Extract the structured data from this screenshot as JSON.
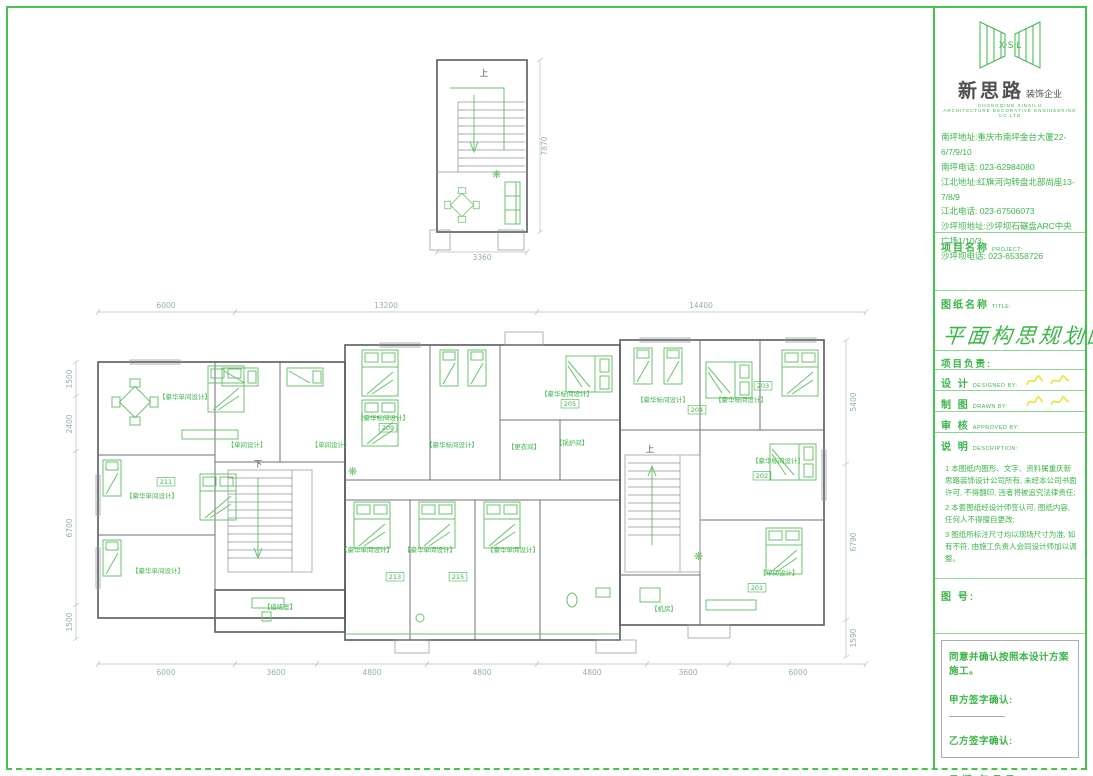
{
  "brand": {
    "logo_initials": "X·S·L",
    "name": "新思路",
    "suffix": "装饰企业",
    "subtitle_cn": "CHONGQING XINSILU",
    "subtitle_en": "ARCHITECTURE DECORATIVE ENGINEERING CO.LTD"
  },
  "addresses": [
    "南坪地址:重庆市南坪金台大厦22-6/7/9/10",
    "南坪电话: 023-62984080",
    "江北地址:红旗河沟转盘北部尚座13-7/8/9",
    "江北电话: 023-67506073",
    "沙坪坝地址:沙坪坝石碾盘ARC中央广场1/10/3",
    "沙坪坝电话: 023-65358726"
  ],
  "title_block": {
    "project_label": "项目名称",
    "project_label_en": "PROJECT:",
    "drawing_label": "图纸名称",
    "drawing_label_en": "TITLE:",
    "drawing_title": "平面构思规划图",
    "lead_label": "项目负责:",
    "design_cn": "设  计",
    "design_en": "DESIGNED BY:",
    "draft_cn": "制  图",
    "draft_en": "DRAWN BY:",
    "review_cn": "审  核",
    "review_en": "APPROVED BY:",
    "desc_cn": "说  明",
    "desc_en": "DESCRIPTION:",
    "notes": [
      "1 本图纸内图形、文字、资料属重庆新思路装饰设计公司所有, 未经本公司书面许可, 不得翻印, 违者将被追究法律责任;",
      "2 本套图纸经设计师签认可, 图纸内容, 任何人不得擅自更改;",
      "3 图纸所标注尺寸均以现场尺寸为准, 如有不符, 由施工负责人会同设计师加以调整。"
    ],
    "sheet_no_label": "图 号:"
  },
  "confirmation": {
    "statement": "同意并确认按照本设计方案施工。",
    "party_a": "甲方签字确认:",
    "party_b": "乙方签字确认:",
    "date_label": "日        期:",
    "date_units": "年      月      日"
  },
  "colors": {
    "frame_green": "#46c24e",
    "label_green": "#3cb54a",
    "furniture_green": "#6cc06c",
    "dimension_text": "#8fb0b6",
    "signature_yellow": "#e9e54a",
    "wall_gray": "#565b5e"
  },
  "plan": {
    "annotations": [
      {
        "t": "6000",
        "x": 166,
        "y": 308,
        "cls": "dim",
        "name": "dim-top-6000"
      },
      {
        "t": "13200",
        "x": 386,
        "y": 308,
        "cls": "dim",
        "name": "dim-top-13200"
      },
      {
        "t": "14400",
        "x": 701,
        "y": 308,
        "cls": "dim",
        "name": "dim-top-14400"
      },
      {
        "t": "6000",
        "x": 166,
        "y": 675,
        "cls": "dim",
        "name": "dim-bottom-6000-l"
      },
      {
        "t": "3600",
        "x": 276,
        "y": 675,
        "cls": "dim",
        "name": "dim-bottom-3600-l"
      },
      {
        "t": "4800",
        "x": 372,
        "y": 675,
        "cls": "dim",
        "name": "dim-bottom-4800-1"
      },
      {
        "t": "4800",
        "x": 482,
        "y": 675,
        "cls": "dim",
        "name": "dim-bottom-4800-2"
      },
      {
        "t": "4800",
        "x": 592,
        "y": 675,
        "cls": "dim",
        "name": "dim-bottom-4800-3"
      },
      {
        "t": "3600",
        "x": 688,
        "y": 675,
        "cls": "dim",
        "name": "dim-bottom-3600-r"
      },
      {
        "t": "6000",
        "x": 798,
        "y": 675,
        "cls": "dim",
        "name": "dim-bottom-6000-r"
      },
      {
        "t": "1500",
        "x": 72,
        "y": 379,
        "cls": "dim",
        "rot": -90,
        "name": "dim-left-1500-t"
      },
      {
        "t": "2400",
        "x": 72,
        "y": 424,
        "cls": "dim",
        "rot": -90,
        "name": "dim-left-2400"
      },
      {
        "t": "6700",
        "x": 72,
        "y": 528,
        "cls": "dim",
        "rot": -90,
        "name": "dim-left-6700"
      },
      {
        "t": "1500",
        "x": 72,
        "y": 622,
        "cls": "dim",
        "rot": -90,
        "name": "dim-left-1500-b"
      },
      {
        "t": "5400",
        "x": 856,
        "y": 402,
        "cls": "dim",
        "rot": -90,
        "name": "dim-right-5400"
      },
      {
        "t": "6790",
        "x": 856,
        "y": 542,
        "cls": "dim",
        "rot": -90,
        "name": "dim-right-6790"
      },
      {
        "t": "1590",
        "x": 856,
        "y": 638,
        "cls": "dim",
        "rot": -90,
        "name": "dim-right-1590"
      },
      {
        "t": "3360",
        "x": 482,
        "y": 260,
        "cls": "dim",
        "name": "dim-upper-3360"
      },
      {
        "t": "7870",
        "x": 547,
        "y": 146,
        "cls": "dim",
        "rot": -90,
        "name": "dim-upper-7870"
      },
      {
        "t": "【豪华单间设计】",
        "x": 185,
        "y": 399,
        "cls": "room"
      },
      {
        "t": "【单间设计】",
        "x": 247,
        "y": 447,
        "cls": "room"
      },
      {
        "t": "【单间设计】",
        "x": 331,
        "y": 447,
        "cls": "room"
      },
      {
        "t": "【豪华单间设计】",
        "x": 152,
        "y": 498,
        "cls": "room"
      },
      {
        "t": "【豪华单间设计】",
        "x": 158,
        "y": 573,
        "cls": "room"
      },
      {
        "t": "【豪华标间设计】",
        "x": 383,
        "y": 420,
        "cls": "room"
      },
      {
        "t": "【豪华标间设计】",
        "x": 452,
        "y": 447,
        "cls": "room"
      },
      {
        "t": "【豪华标间设计】",
        "x": 567,
        "y": 396,
        "cls": "room"
      },
      {
        "t": "【豪华标间设计】",
        "x": 663,
        "y": 402,
        "cls": "room"
      },
      {
        "t": "【豪华标间设计】",
        "x": 741,
        "y": 402,
        "cls": "room"
      },
      {
        "t": "【豪华标间设计】",
        "x": 778,
        "y": 463,
        "cls": "room"
      },
      {
        "t": "【豪华单间设计】",
        "x": 367,
        "y": 552,
        "cls": "room"
      },
      {
        "t": "【豪华单间设计】",
        "x": 430,
        "y": 552,
        "cls": "room"
      },
      {
        "t": "【豪华单间设计】",
        "x": 513,
        "y": 552,
        "cls": "room"
      },
      {
        "t": "【单间设计】",
        "x": 779,
        "y": 575,
        "cls": "room"
      },
      {
        "t": "【值班室】",
        "x": 280,
        "y": 609,
        "cls": "room"
      },
      {
        "t": "【更衣间】",
        "x": 524,
        "y": 449,
        "cls": "room"
      },
      {
        "t": "【锅炉间】",
        "x": 572,
        "y": 445,
        "cls": "room"
      },
      {
        "t": "【机房】",
        "x": 664,
        "y": 611,
        "cls": "room"
      },
      {
        "t": "211",
        "x": 166,
        "y": 484,
        "cls": "roomno"
      },
      {
        "t": "209",
        "x": 388,
        "y": 430,
        "cls": "roomno"
      },
      {
        "t": "205",
        "x": 570,
        "y": 406,
        "cls": "roomno"
      },
      {
        "t": "213",
        "x": 395,
        "y": 579,
        "cls": "roomno"
      },
      {
        "t": "215",
        "x": 458,
        "y": 579,
        "cls": "roomno"
      },
      {
        "t": "204",
        "x": 697,
        "y": 412,
        "cls": "roomno"
      },
      {
        "t": "203",
        "x": 763,
        "y": 388,
        "cls": "roomno"
      },
      {
        "t": "202",
        "x": 762,
        "y": 478,
        "cls": "roomno"
      },
      {
        "t": "201",
        "x": 757,
        "y": 590,
        "cls": "roomno"
      },
      {
        "t": "下",
        "x": 258,
        "y": 467,
        "cls": "stair",
        "name": "stair-down-label"
      },
      {
        "t": "上",
        "x": 650,
        "y": 452,
        "cls": "stair",
        "name": "stair-up-label"
      },
      {
        "t": "上",
        "x": 484,
        "y": 76,
        "cls": "stair",
        "name": "upper-stair-up-label"
      }
    ]
  }
}
